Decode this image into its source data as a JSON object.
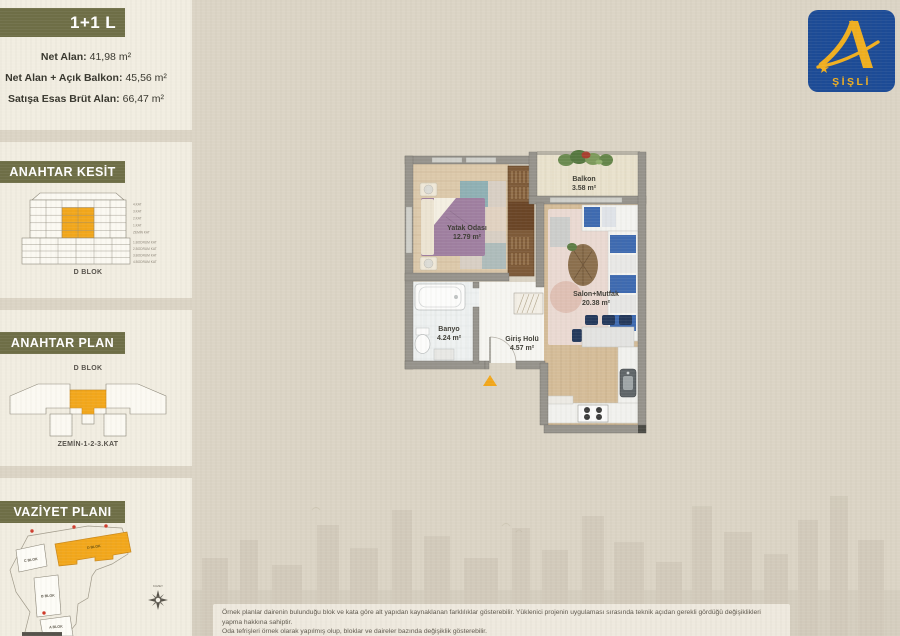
{
  "unit": {
    "type_label": "1+1 L"
  },
  "stats": {
    "rows": [
      {
        "label": "Net Alan:",
        "value": "41,98 m²"
      },
      {
        "label": "Net Alan + Açık Balkon:",
        "value": "45,56 m²"
      },
      {
        "label": "Satışa Esas Brüt Alan:",
        "value": "66,47 m²"
      }
    ]
  },
  "key_section": {
    "title": "ANAHTAR KESİT",
    "block_label": "D BLOK",
    "floor_labels": [
      "4.KAT",
      "3.KAT",
      "2.KAT",
      "1.KAT",
      "ZEMİN KAT",
      "1.BODRUM KAT",
      "2.BODRUM KAT",
      "3.BODRUM KAT",
      "4.BODRUM KAT"
    ]
  },
  "key_plan": {
    "title": "ANAHTAR PLAN",
    "block_label": "D BLOK",
    "floors_label": "ZEMİN-1-2-3.KAT"
  },
  "site_plan": {
    "title": "VAZİYET PLANI",
    "compass_label": "KUZEY",
    "highlighted_block": "D BLOK",
    "blocks": {
      "a": "A BLOK",
      "b": "B BLOK",
      "c": "C BLOK",
      "d": "D BLOK"
    }
  },
  "floorplan": {
    "rooms": {
      "bedroom": {
        "name": "Yatak Odası",
        "area": "12.79 m²"
      },
      "balcony": {
        "name": "Balkon",
        "area": "3.58 m²"
      },
      "living": {
        "name": "Salon+Mutfak",
        "area": "20.38 m²"
      },
      "bathroom": {
        "name": "Banyo",
        "area": "4.24 m²"
      },
      "hall": {
        "name": "Giriş Holü",
        "area": "4.57 m²"
      }
    }
  },
  "logo": {
    "letter": "A",
    "brand": "ŞİŞLİ"
  },
  "disclaimer": {
    "line1": "Örnek planlar dairenin bulunduğu blok ve kata göre alt yapıdan kaynaklanan farklılıklar gösterebilir. Yüklenici projenin uygulaması sırasında teknik açıdan gerekli gördüğü değişiklikleri yapma hakkına sahiptir.",
    "line2": "Oda tefrişleri örnek olarak yapılmış olup, bloklar ve daireler bazında değişiklik gösterebilir."
  },
  "colors": {
    "accent_orange": "#F2A71B",
    "banner_olive": "#6E6E46",
    "logo_blue": "#1C4B96",
    "logo_gold": "#F0AF1F"
  }
}
